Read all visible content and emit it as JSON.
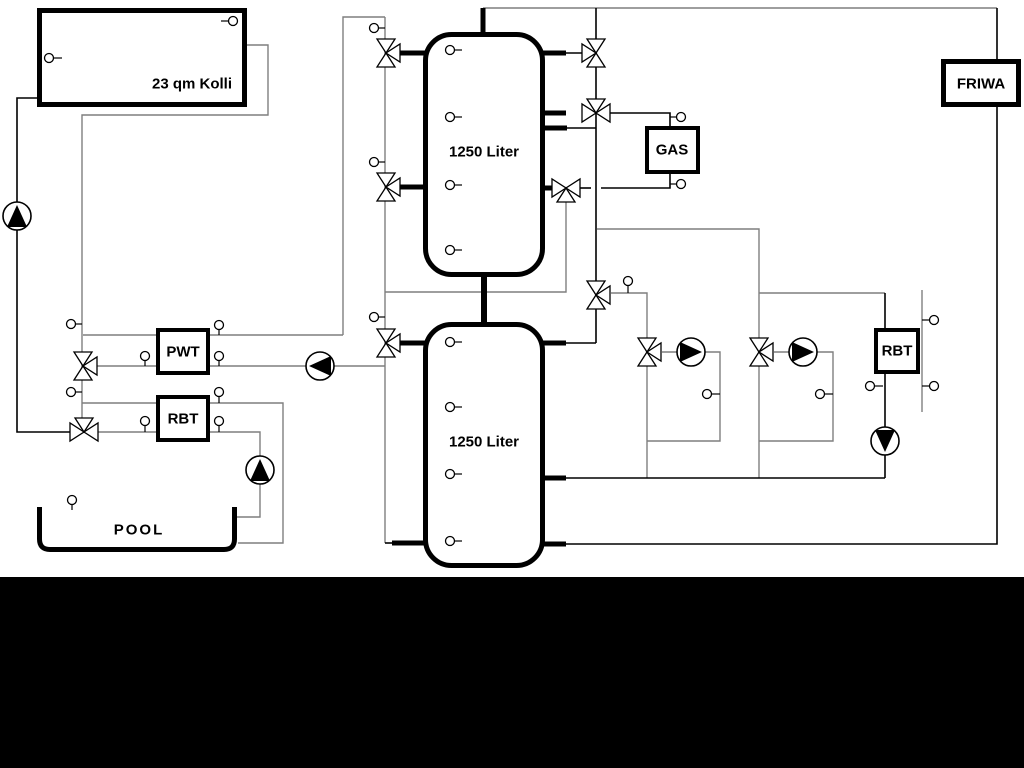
{
  "diagram": {
    "type": "hydraulic-schematic",
    "labels": {
      "collector": "23 qm Kolli",
      "tank_upper": "1250 Liter",
      "tank_lower": "1250 Liter",
      "pwt": "PWT",
      "rbt_left": "RBT",
      "gas": "GAS",
      "friwa": "FRIWA",
      "rbt_right": "RBT",
      "pool": "POOL"
    },
    "components": {
      "pumps": [
        "solar-pump",
        "pwt-secondary-pump",
        "pool-pump",
        "heating-circuit-1-pump",
        "heating-circuit-2-pump",
        "rbt-right-pump"
      ],
      "three_way_valves": [
        "solar-pwt-valve",
        "solar-rbt-valve",
        "tank1-left-upper-valve",
        "tank1-left-lower-valve",
        "tank2-left-valve",
        "tank1-top-right-valve",
        "gas-supply-valve",
        "gas-return-valve",
        "circuit-riser-valve",
        "circuit1-mixing-valve",
        "circuit2-mixing-valve"
      ],
      "temperature_sensor_count": 30
    },
    "colors": {
      "pipe_gray": "#7f7f7f",
      "pipe_black": "#000000",
      "background": "#ffffff",
      "bottom_mask": "#000000"
    }
  }
}
